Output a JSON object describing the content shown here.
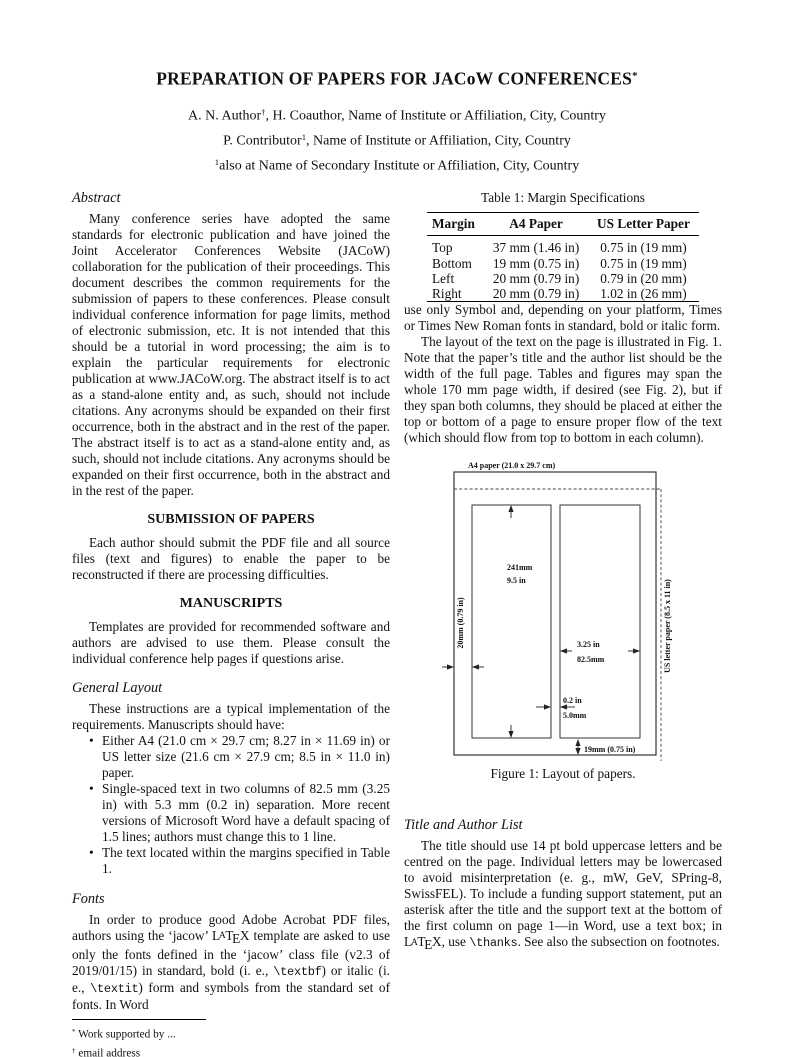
{
  "ink_color": "#111111",
  "paper_color": "#ffffff",
  "header": {
    "title": [
      {
        "t": "PREPARATION OF PAPERS FOR JACoW CONFERENCES"
      },
      {
        "t": "*",
        "s": "sup"
      }
    ],
    "author_lines": [
      [
        {
          "t": "A. N. Author"
        },
        {
          "t": "†",
          "s": "sup"
        },
        {
          "t": ", H. Coauthor, Name of Institute or Affiliation, City, Country"
        }
      ],
      [
        {
          "t": "P. Contributor"
        },
        {
          "t": "1",
          "s": "sup"
        },
        {
          "t": ", Name of Institute or Affiliation, City, Country"
        }
      ],
      [
        {
          "t": "1",
          "s": "sup"
        },
        {
          "t": "also at Name of Secondary Institute or Affiliation, City, Country"
        }
      ]
    ]
  },
  "left_column": {
    "abstract": {
      "heading": "Abstract",
      "body": "Many conference series have adopted the same standards for electronic publication and have joined the Joint Accelerator Conferences Website (JACoW) collaboration for the publication of their proceedings. This document describes the common requirements for the submission of papers to these conferences. Please consult individual conference information for page limits, method of electronic submission, etc. It is not intended that this should be a tutorial in word processing; the aim is to explain the particular requirements for electronic publication at www.JACoW.org. The abstract itself is to act as a stand-alone entity and, as such, should not include citations. Any acronyms should be expanded on their first occurrence, both in the abstract and in the rest of the paper. The abstract itself is to act as a stand-alone entity and, as such, should not include citations. Any acronyms should be expanded on their first occurrence, both in the abstract and in the rest of the paper."
    },
    "submission": {
      "heading": "SUBMISSION OF PAPERS",
      "body": "Each author should submit the PDF file and all source files (text and figures) to enable the paper to be reconstructed if there are processing difficulties."
    },
    "manuscripts": {
      "heading": "MANUSCRIPTS",
      "body": "Templates are provided for recommended software and authors are advised to use them. Please consult the individual conference help pages if questions arise."
    },
    "general_layout": {
      "heading": "General Layout",
      "intro": "These instructions are a typical implementation of the requirements. Manuscripts should have:",
      "bullets": [
        "Either A4 (21.0 cm × 29.7 cm; 8.27 in × 11.69 in) or US letter size (21.6 cm × 27.9 cm; 8.5 in × 11.0 in) paper.",
        "Single-spaced text in two columns of 82.5 mm (3.25 in) with 5.3 mm (0.2 in) separation. More recent versions of Microsoft Word have a default spacing of 1.5 lines; authors must change this to 1 line.",
        "The text located within the margins specified in Table 1."
      ]
    },
    "fonts": {
      "heading": "Fonts",
      "body_rich": [
        {
          "t": "In order to produce good Adobe Acrobat PDF files, authors using the ‘jacow’ "
        },
        {
          "t": "L"
        },
        {
          "t": "A",
          "s": "texa"
        },
        {
          "t": "T"
        },
        {
          "t": "E",
          "s": "texe"
        },
        {
          "t": "X"
        },
        {
          "t": " template are asked to use only the fonts defined in the ‘jacow’ class file (v2.3 of 2019/01/15) in standard, bold (i. e., "
        },
        {
          "t": "\\textbf",
          "s": "tt"
        },
        {
          "t": ") or italic (i. e., "
        },
        {
          "t": "\\textit",
          "s": "tt"
        },
        {
          "t": ") form and symbols from the standard set of fonts. In Word"
        }
      ]
    },
    "footnotes": [
      [
        {
          "t": "*",
          "s": "sup"
        },
        {
          "t": " Work supported by ..."
        }
      ],
      [
        {
          "t": "†",
          "s": "sup"
        },
        {
          "t": " email address"
        }
      ]
    ]
  },
  "right_column": {
    "table": {
      "caption": "Table 1: Margin Specifications",
      "headers": [
        "Margin",
        "A4 Paper",
        "US Letter Paper"
      ],
      "rows": [
        [
          "Top",
          "37 mm (1.46 in)",
          "0.75 in (19 mm)"
        ],
        [
          "Bottom",
          "19 mm (0.75 in)",
          "0.75 in (19 mm)"
        ],
        [
          "Left",
          "20 mm (0.79 in)",
          "0.79 in (20 mm)"
        ],
        [
          "Right",
          "20 mm (0.79 in)",
          "1.02 in (26 mm)"
        ]
      ]
    },
    "para_fonts_cont": "use only Symbol and, depending on your platform, Times or Times New Roman fonts in standard, bold or italic form.",
    "para_layout": "The layout of the text on the page is illustrated in Fig. 1. Note that the paper’s title and the author list should be the width of the full page. Tables and figures may span the whole 170 mm page width, if desired (see Fig. 2), but if they span both columns, they should be placed at either the top or bottom of a page to ensure proper flow of the text (which should flow from top to bottom in each column).",
    "figure": {
      "a4_label": "A4 paper (21.0 x 29.7 cm)",
      "us_letter_label": "US letter paper (8.5 x 11 in)",
      "col_height_line1": "241mm",
      "col_height_line2": "9.5 in",
      "left_margin_label": "20mm (0.79 in)",
      "col_width_line1": "3.25 in",
      "col_width_line2": "82.5mm",
      "gap_line1": "0.2 in",
      "gap_line2": "5.0mm",
      "bottom_margin_label": "19mm (0.75 in)",
      "caption": "Figure 1: Layout of papers."
    },
    "title_author": {
      "heading": "Title and Author List",
      "body_rich": [
        {
          "t": "The title should use 14 pt bold uppercase letters and be centred on the page. Individual letters may be lowercased to avoid misinterpretation (e. g., mW, GeV, SPring-8, SwissFEL). To include a funding support statement, put an asterisk after the title and the support text at the bottom of the first column on page 1—in Word, use a text box; in "
        },
        {
          "t": "L"
        },
        {
          "t": "A",
          "s": "texa"
        },
        {
          "t": "T"
        },
        {
          "t": "E",
          "s": "texe"
        },
        {
          "t": "X"
        },
        {
          "t": ", use "
        },
        {
          "t": "\\thanks",
          "s": "tt"
        },
        {
          "t": ". See also the subsection on footnotes."
        }
      ]
    }
  }
}
